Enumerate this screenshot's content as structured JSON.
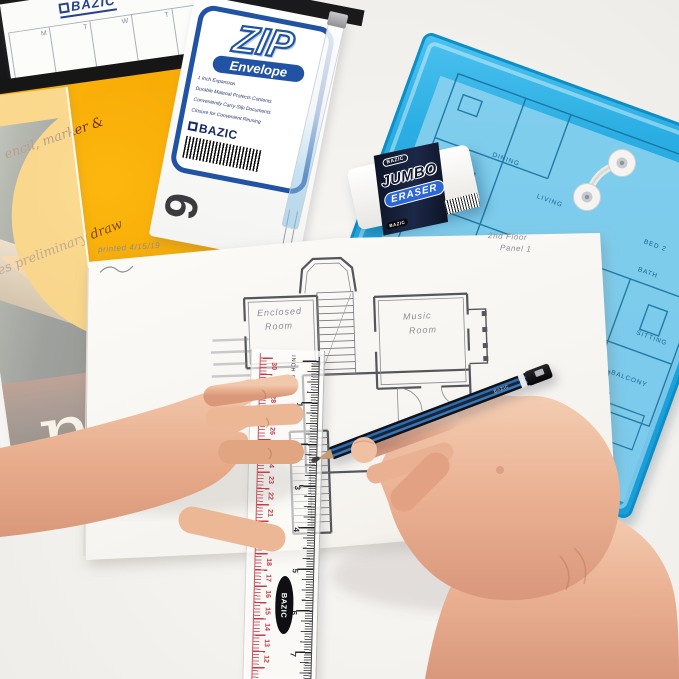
{
  "scene": {
    "description": "BAZIC stationery flat lay; two hands drafting a house floor plan with pencil and ruler"
  },
  "calendar": {
    "brand": "BAZIC",
    "day_letters": [
      "M",
      "T",
      "W",
      "T",
      "F"
    ]
  },
  "drawing_pad": {
    "tagline_top": "encil, marker &",
    "tagline_script": "hes preliminary draw",
    "title_fragment": "ng",
    "subtitle": "pad"
  },
  "zip_package": {
    "title": "ZIP",
    "subtitle": "Envelope",
    "features": [
      "1 Inch Expansion",
      "Durable Material Protects Contents",
      "Conveniently Carry Slip Documents",
      "Closure for Convenient Reusing"
    ],
    "brand": "BAZIC",
    "size_digit": "6"
  },
  "eraser": {
    "brand_top": "BAZIC",
    "name_line1": "JUMBO",
    "name_line2": "ERASER",
    "brand_bottom": "BAZIC"
  },
  "floor_plan": {
    "note_printed": "printed 4/15/19",
    "note_floor": "2nd Floor",
    "note_panel": "Panel 1",
    "room_left_line1": "Enclosed",
    "room_left_line2": "Room",
    "room_right_line1": "Music",
    "room_right_line2": "Room"
  },
  "blue_envelope": {
    "room_labels": [
      "DINING",
      "LIVING",
      "BED 2",
      "BATH",
      "BED 1",
      "SITTING",
      "BALCONY"
    ]
  },
  "ruler": {
    "brand": "BAZIC",
    "scale_label": "INCH 0",
    "cm_numbers": [
      12,
      13,
      14,
      15,
      16,
      17,
      18,
      19,
      20,
      21,
      22,
      23,
      24,
      25,
      26,
      27,
      28,
      29,
      30
    ],
    "inch_numbers": [
      1,
      2,
      3,
      4,
      5,
      6,
      7
    ]
  },
  "pencil": {
    "brand": "BAZIC"
  }
}
